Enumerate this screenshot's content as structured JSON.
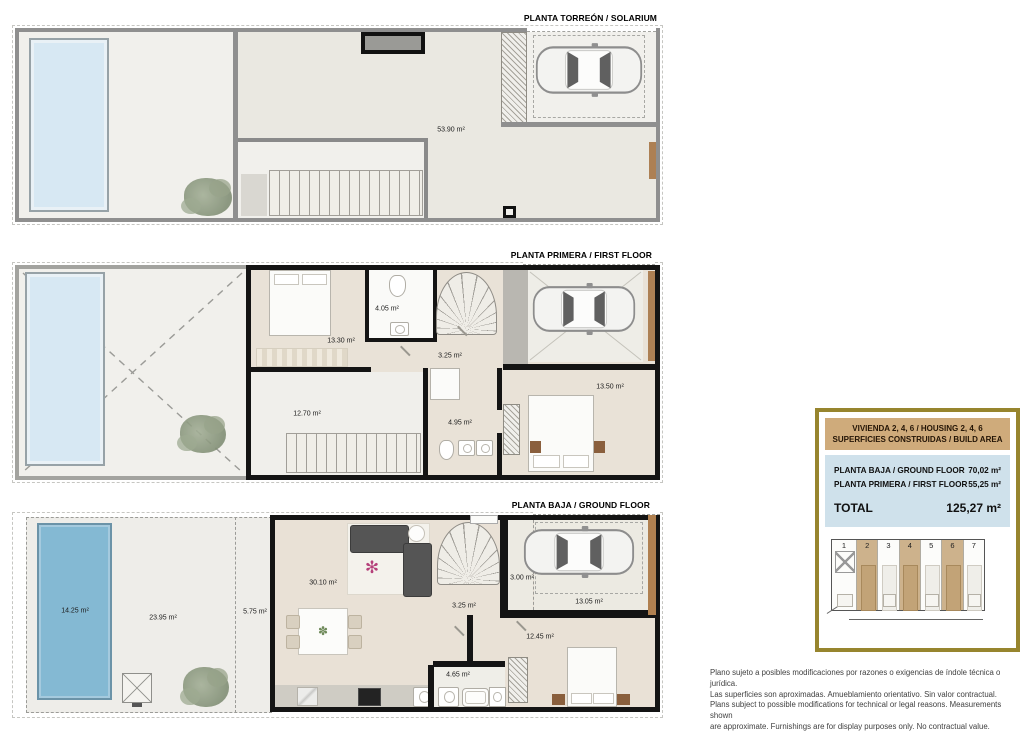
{
  "plans": {
    "torreon": {
      "title": "PLANTA TORREÓN / SOLARIUM",
      "rooms": {
        "solarium": "53.90 m²"
      }
    },
    "first": {
      "title": "PLANTA PRIMERA / FIRST FLOOR",
      "rooms": {
        "bedroom1": "13.30 m²",
        "bath1": "4.05 m²",
        "hall": "3.25 m²",
        "bedroom2": "13.50 m²",
        "terrace": "12.70 m²",
        "bath2": "4.95 m²"
      }
    },
    "ground": {
      "title": "PLANTA BAJA / GROUND FLOOR",
      "rooms": {
        "pool": "14.25 m²",
        "garden": "23.95 m²",
        "porch": "5.75 m²",
        "living": "30.10 m²",
        "entry": "3.00 m²",
        "hall": "3.25 m²",
        "carport": "13.05 m²",
        "bedroom": "12.45 m²",
        "bath": "4.65 m²"
      }
    }
  },
  "legend": {
    "header_line1": "VIVIENDA 2, 4, 6 / HOUSING 2, 4, 6",
    "header_line2": "SUPERFICIES CONSTRUIDAS / BUILD AREA",
    "rows": [
      {
        "label": "PLANTA BAJA / GROUND FLOOR",
        "value": "70,02 m²"
      },
      {
        "label": "PLANTA PRIMERA / FIRST FLOOR",
        "value": "55,25 m²"
      }
    ],
    "total_label": "TOTAL",
    "total_value": "125,27 m²",
    "siteplan": {
      "units": [
        {
          "n": "1",
          "highlighted": false
        },
        {
          "n": "2",
          "highlighted": true
        },
        {
          "n": "3",
          "highlighted": false
        },
        {
          "n": "4",
          "highlighted": true
        },
        {
          "n": "5",
          "highlighted": false
        },
        {
          "n": "6",
          "highlighted": true
        },
        {
          "n": "7",
          "highlighted": false
        }
      ]
    }
  },
  "disclaimer": {
    "lines": [
      "Plano sujeto a posibles modificaciones por razones o exigencias de índole técnica o jurídica.",
      "Las superficies son aproximadas. Amueblamiento orientativo. Sin valor contractual.",
      "Plans subject to possible modifications for technical or legal reasons. Measurements shown",
      "are approximate. Furnishings are for display purposes only. No contractual value."
    ]
  },
  "colors": {
    "legend_border": "#97852e",
    "legend_header_bg": "#cfab7b",
    "legend_table_bg": "#cfe1eb",
    "unit_highlight": "#cdb28c",
    "pool_light": "#d7e8f3",
    "pool_deep": "#84b9d3",
    "wall_dark": "#141414",
    "wall_gray": "#8f8f8f",
    "floor_beige": "#e9e2d7"
  }
}
